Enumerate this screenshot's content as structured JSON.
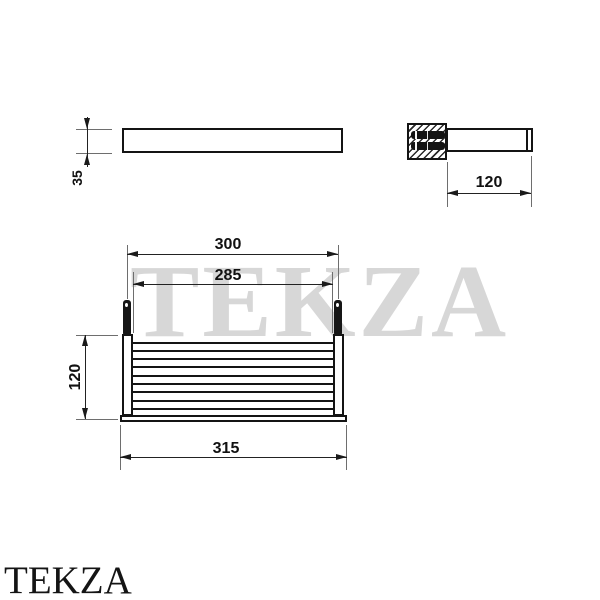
{
  "watermark_text": "TEKZA",
  "footer_logo_text": "TEKZA",
  "drawing": {
    "side_view": {
      "height_label": "35"
    },
    "end_view": {
      "depth_label": "120"
    },
    "front_view": {
      "mount_span_label": "300",
      "inner_width_label": "285",
      "height_label": "120",
      "overall_width_label": "315"
    }
  },
  "colors": {
    "background": "#ffffff",
    "outline": "#141414",
    "dimension_line": "#222222",
    "extension_line": "#6e6e6e",
    "watermark": "#d7d7d7",
    "text": "#111111"
  }
}
